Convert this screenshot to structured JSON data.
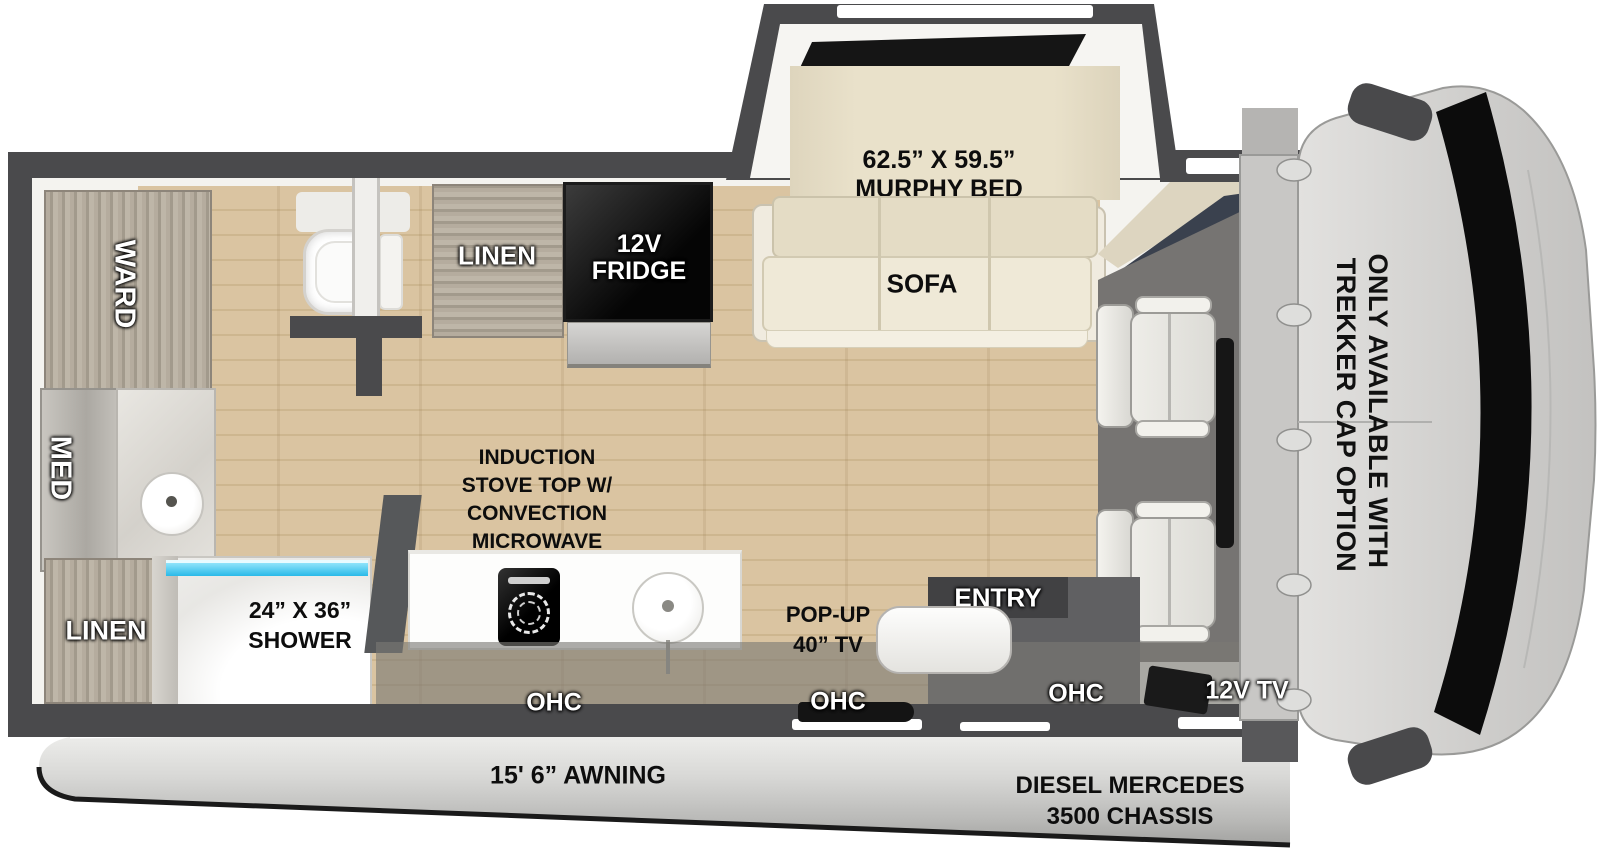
{
  "colors": {
    "wall": "#4a4a4c",
    "floor_wood": "#d9c3a0",
    "cabinet_wood": "#aaa193",
    "bed_beige": "#e7dfc8",
    "shower_glass": "#3fc9f2",
    "cab_body": "#d2d1cf",
    "appliance_black": "#111111"
  },
  "slideout": {
    "dimensions": "62.5” X 59.5”",
    "name": "MURPHY BED",
    "sofa": "SOFA"
  },
  "kitchen": {
    "linen": "LINEN",
    "fridge": [
      "12V",
      "FRIDGE"
    ],
    "stove_note": [
      "INDUCTION",
      "STOVE TOP W/",
      "CONVECTION",
      "MICROWAVE"
    ],
    "popup_tv": [
      "POP-UP",
      "40” TV"
    ],
    "ohc_left": "OHC",
    "ohc_mid": "OHC",
    "ohc_right": "OHC"
  },
  "bathroom": {
    "ward": "WARD",
    "med": "MED",
    "linen": "LINEN",
    "shower": [
      "24” X 36”",
      "SHOWER"
    ]
  },
  "entry": {
    "label": "ENTRY"
  },
  "cab": {
    "note": [
      "ONLY AVAILABLE WITH",
      "TREKKER CAP OPTION"
    ],
    "tv": "12V TV"
  },
  "exterior": {
    "awning": "15' 6” AWNING",
    "chassis": [
      "DIESEL MERCEDES",
      "3500 CHASSIS"
    ]
  }
}
